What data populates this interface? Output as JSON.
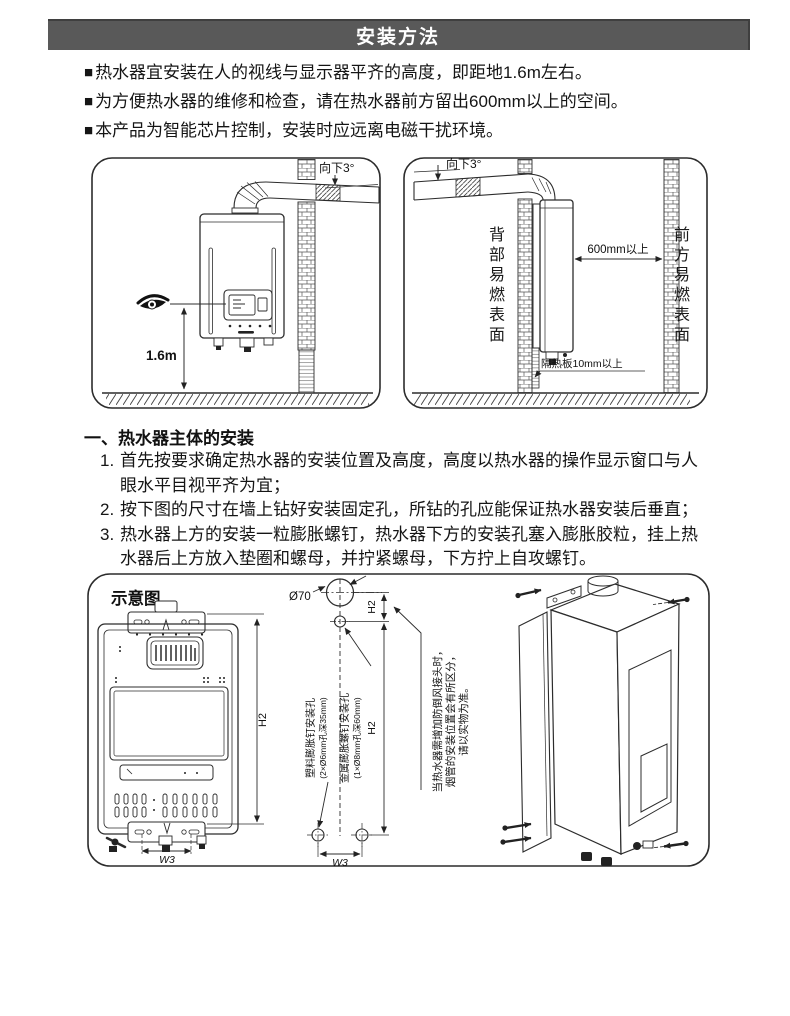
{
  "page": {
    "header": {
      "title": "安装方法"
    },
    "bullet_marker": "■",
    "bullets": [
      "热水器宜安装在人的视线与显示器平齐的高度，即距地1.6m左右。",
      "为方便热水器的维修和检查，请在热水器前方留出600mm以上的空间。",
      "本产品为智能芯片控制，安装时应远离电磁干扰环境。"
    ],
    "section": {
      "heading": "一、热水器主体的安装",
      "steps": [
        {
          "num": "1.",
          "text": "首先按要求确定热水器的安装位置及高度，高度以热水器的操作显示窗口与人眼水平目视平齐为宜；"
        },
        {
          "num": "2.",
          "text": "按下图的尺寸在墙上钻好安装固定孔，所钻的孔应能保证热水器安装后垂直；"
        },
        {
          "num": "3.",
          "text": "热水器上方的安装一粒膨胀螺钉，热水器下方的安装孔塞入膨胀胶粒，挂上热水器后上方放入垫圈和螺母，并拧紧螺母，下方拧上自攻螺钉。"
        }
      ]
    },
    "diagram_front": {
      "tilt_label": "向下3°",
      "eye_height_label": "1.6m"
    },
    "diagram_side": {
      "tilt_label": "向下3°",
      "back_surface_label": "背部易燃表面",
      "front_surface_label": "前方易燃表面",
      "clearance_label": "600mm以上",
      "insulation_label": "隔热板10mm以上"
    },
    "schematic": {
      "title": "示意图",
      "flue_diameter_label": "Ø70",
      "h2_front_label": "H2",
      "h2_top_label": "H2",
      "h2_main_label": "H2",
      "w3_front_label": "W3",
      "w3_template_label": "W3",
      "plastic_hole_label_line1": "塑料膨胀钉安装孔",
      "plastic_hole_label_line2": "(2×Ø6mm孔深35mm)",
      "metal_hole_label_line1": "金属膨胀螺钉安装孔",
      "metal_hole_label_line2": "(1×Ø8mm孔深60mm)",
      "note_line1": "当热水器需增加防倒风接头时，",
      "note_line2": "烟管的安装位置会有所区分，",
      "note_line3": "请以实物为准。"
    },
    "colors": {
      "header_bg": "#595959",
      "header_text": "#ffffff",
      "ink": "#1a1a1a"
    }
  }
}
